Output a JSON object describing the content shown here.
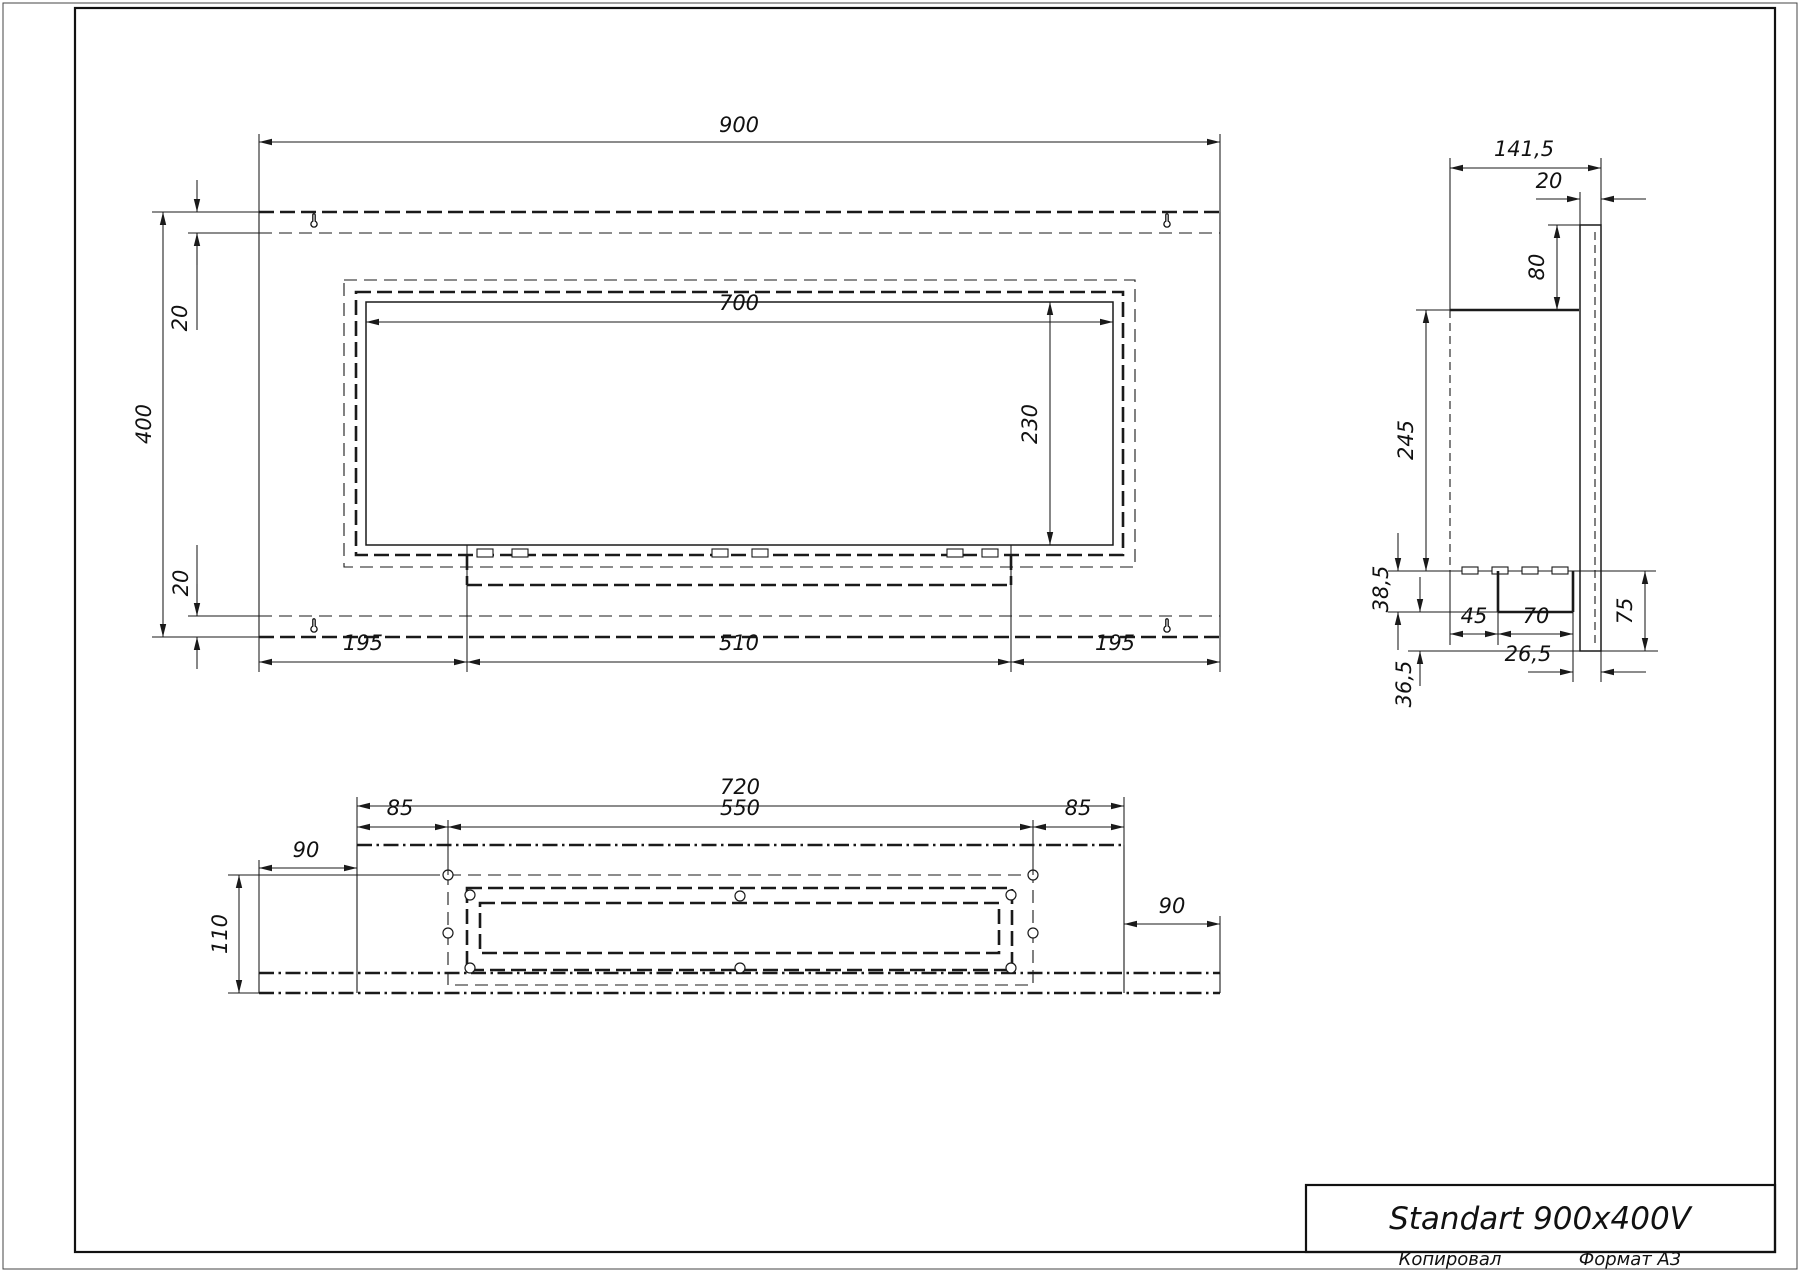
{
  "title_block": {
    "model": "Standart 900x400V"
  },
  "footer": {
    "copied_by": "Копировал",
    "format": "Формат А3"
  },
  "front_view": {
    "overall_width": "900",
    "overall_height": "400",
    "top_inset": "20",
    "bottom_inset": "20",
    "opening_width": "700",
    "opening_height": "230",
    "left_offset": "195",
    "burner_width": "510",
    "right_offset": "195"
  },
  "side_view": {
    "overall_depth": "141,5",
    "bracket_thickness": "20",
    "bracket_overhang": "80",
    "body_height": "245",
    "tray_height": "38,5",
    "bottom_overhang": "36,5",
    "lower_height": "75",
    "tray_offset": "45",
    "tray_width": "70",
    "back_clearance": "26,5"
  },
  "plan_view": {
    "body_width": "720",
    "left_edge": "85",
    "cutout_width": "550",
    "right_edge": "85",
    "flange_left": "90",
    "body_depth": "110",
    "flange_right": "90"
  }
}
